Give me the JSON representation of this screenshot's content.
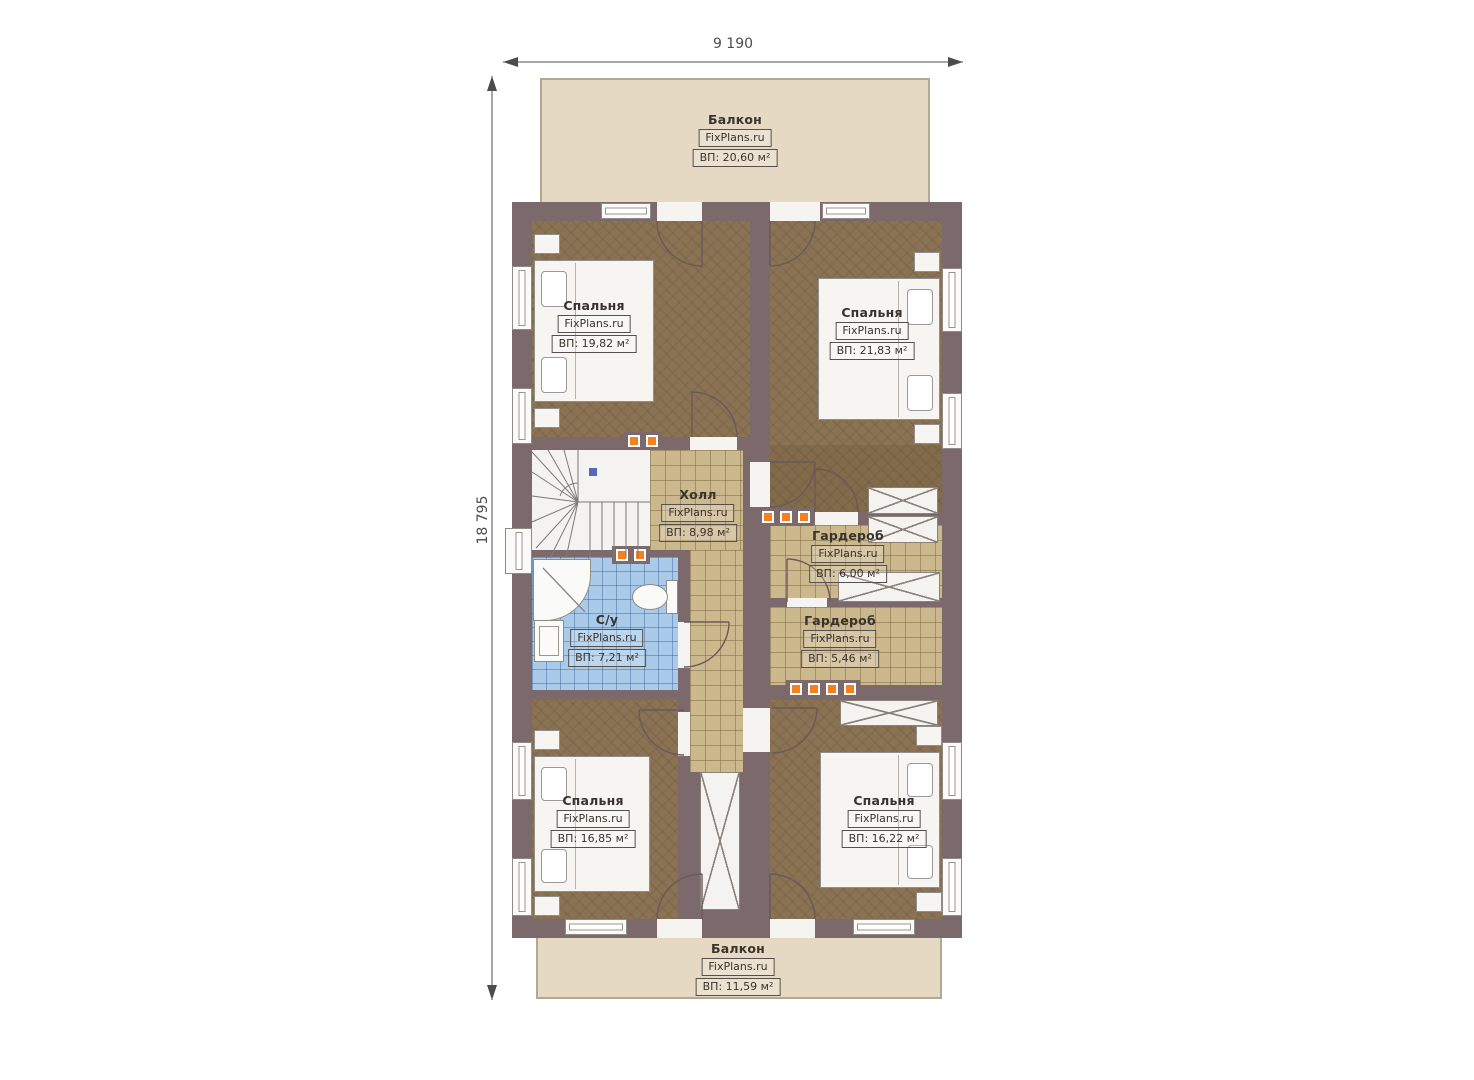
{
  "dimensions": {
    "width_label": "9 190",
    "height_label": "18 795"
  },
  "brand": "FixPlans.ru",
  "rooms": {
    "balcony_top": {
      "name": "Балкон",
      "area": "ВП: 20,60 м²"
    },
    "bedroom_tl": {
      "name": "Спальня",
      "area": "ВП: 19,82 м²"
    },
    "bedroom_tr": {
      "name": "Спальня",
      "area": "ВП: 21,83 м²"
    },
    "hall": {
      "name": "Холл",
      "area": "ВП: 8,98 м²"
    },
    "wardrobe_upper": {
      "name": "Гардероб",
      "area": "ВП: 6,00 м²"
    },
    "wardrobe_lower": {
      "name": "Гардероб",
      "area": "ВП: 5,46 м²"
    },
    "bathroom": {
      "name": "С/у",
      "area": "ВП: 7,21 м²"
    },
    "bedroom_bl": {
      "name": "Спальня",
      "area": "ВП: 16,85 м²"
    },
    "bedroom_br": {
      "name": "Спальня",
      "area": "ВП: 16,22 м²"
    },
    "balcony_bottom": {
      "name": "Балкон",
      "area": "ВП: 11,59 м²"
    }
  },
  "colors": {
    "wall": "#7b696c",
    "bedroom_floor": "#8a7253",
    "tile": "#ccb88d",
    "bath": "#a9cbe9",
    "balcony": "#e6d9c3",
    "marker": "#f5801e"
  }
}
